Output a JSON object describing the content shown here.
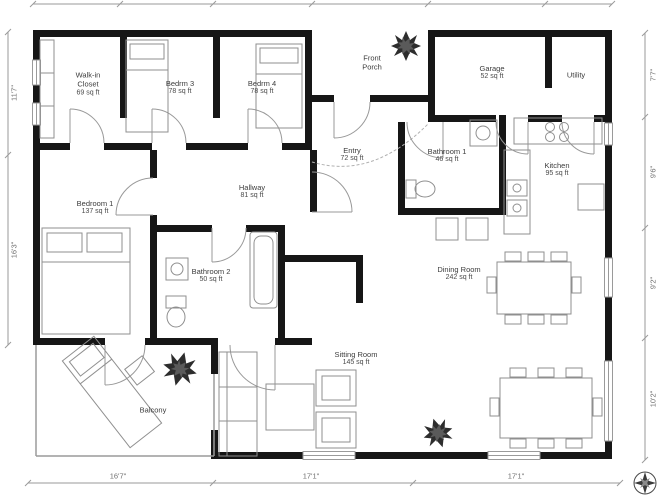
{
  "plan": {
    "type": "2d-floor-plan",
    "units": "sq ft"
  },
  "rooms": [
    {
      "name": "Walk-in Closet",
      "area": "69 sq ft"
    },
    {
      "name": "Bedrm 3",
      "area": "78 sq ft"
    },
    {
      "name": "Bedrm 4",
      "area": "78 sq ft"
    },
    {
      "name": "Front Porch",
      "area": ""
    },
    {
      "name": "Garage",
      "area": "52 sq ft"
    },
    {
      "name": "Utility",
      "area": ""
    },
    {
      "name": "Entry",
      "area": "72 sq ft"
    },
    {
      "name": "Bathroom 1",
      "area": "46 sq ft"
    },
    {
      "name": "Kitchen",
      "area": "95 sq ft"
    },
    {
      "name": "Bedroom 1",
      "area": "137 sq ft"
    },
    {
      "name": "Hallway",
      "area": "81 sq ft"
    },
    {
      "name": "Bathroom 2",
      "area": "50 sq ft"
    },
    {
      "name": "Dining Room",
      "area": "242 sq ft"
    },
    {
      "name": "Sitting Room",
      "area": "145 sq ft"
    },
    {
      "name": "Balcony",
      "area": ""
    }
  ],
  "dimensions": {
    "bottom": [
      "16'7\"",
      "17'1\"",
      "17'1\""
    ],
    "left": [
      "11'7\"",
      "16'3\""
    ],
    "right": [
      "7'7\"",
      "9'6\"",
      "9'2\"",
      "10'2\""
    ]
  },
  "icons": [
    {
      "name": "plant-icon",
      "meaning": "potted plant decoration"
    },
    {
      "name": "compass-icon",
      "meaning": "compass rose / north indicator"
    }
  ],
  "colors": {
    "wall": "#161616",
    "furniture_line": "#8f8f8f",
    "dimension_line": "#9a9a9a",
    "label_text": "#3c3c3c",
    "plant": "#2d2d2d",
    "background": "#ffffff"
  }
}
